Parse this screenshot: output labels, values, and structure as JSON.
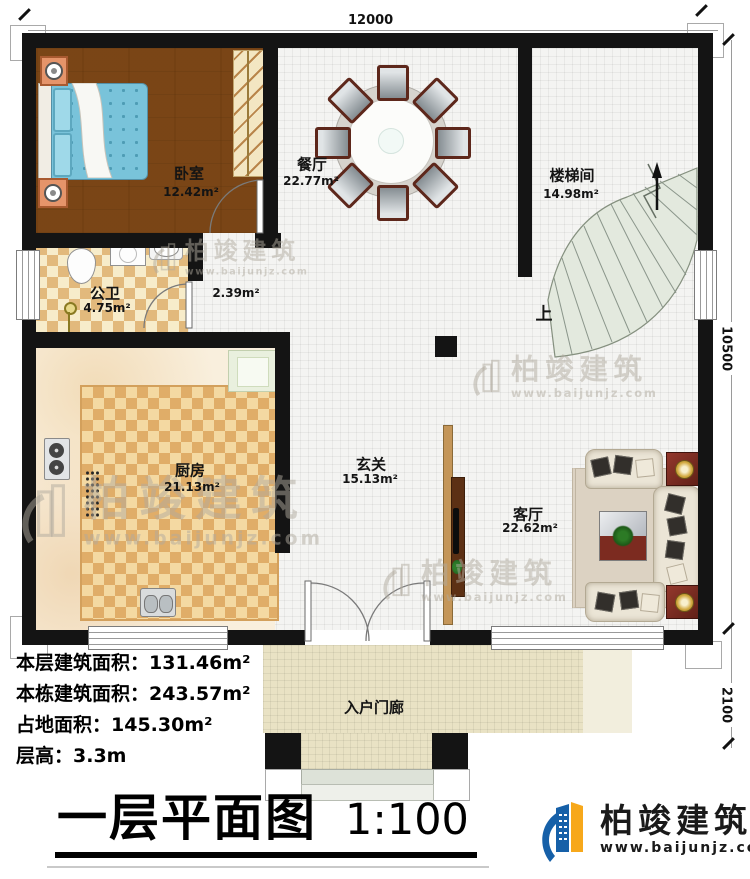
{
  "dimensions": {
    "top": "12000",
    "right_upper": "10500",
    "right_lower": "2100"
  },
  "rooms": [
    {
      "name": "卧室",
      "area": "12.42m²"
    },
    {
      "name": "餐厅",
      "area": "22.77m²"
    },
    {
      "name": "楼梯间",
      "area": "14.98m²"
    },
    {
      "name": "公卫",
      "area": "4.75m²"
    },
    {
      "name": "",
      "area": "2.39m²"
    },
    {
      "name": "厨房",
      "area": "21.13m²"
    },
    {
      "name": "玄关",
      "area": "15.13m²"
    },
    {
      "name": "客厅",
      "area": "22.62m²"
    },
    {
      "name": "入户门廊",
      "area": ""
    }
  ],
  "stairs": {
    "up_label": "上"
  },
  "info": {
    "lines": [
      {
        "label": "本层建筑面积：",
        "value": "131.46m²"
      },
      {
        "label": "本栋建筑面积：",
        "value": "243.57m²"
      },
      {
        "label": "占地面积：",
        "value": "145.30m²"
      },
      {
        "label": "层高：",
        "value": "3.3m"
      }
    ]
  },
  "title": {
    "text": "一层平面图",
    "scale": "1:100"
  },
  "brand": {
    "name": "柏竣建筑",
    "url": "www.baijunjz.com"
  },
  "watermark": {
    "name": "柏竣建筑",
    "url": "www.baijunjz.com"
  },
  "colors": {
    "wall": "#141414",
    "brand_blue": "#1660a8",
    "brand_orange": "#f7a81b"
  }
}
